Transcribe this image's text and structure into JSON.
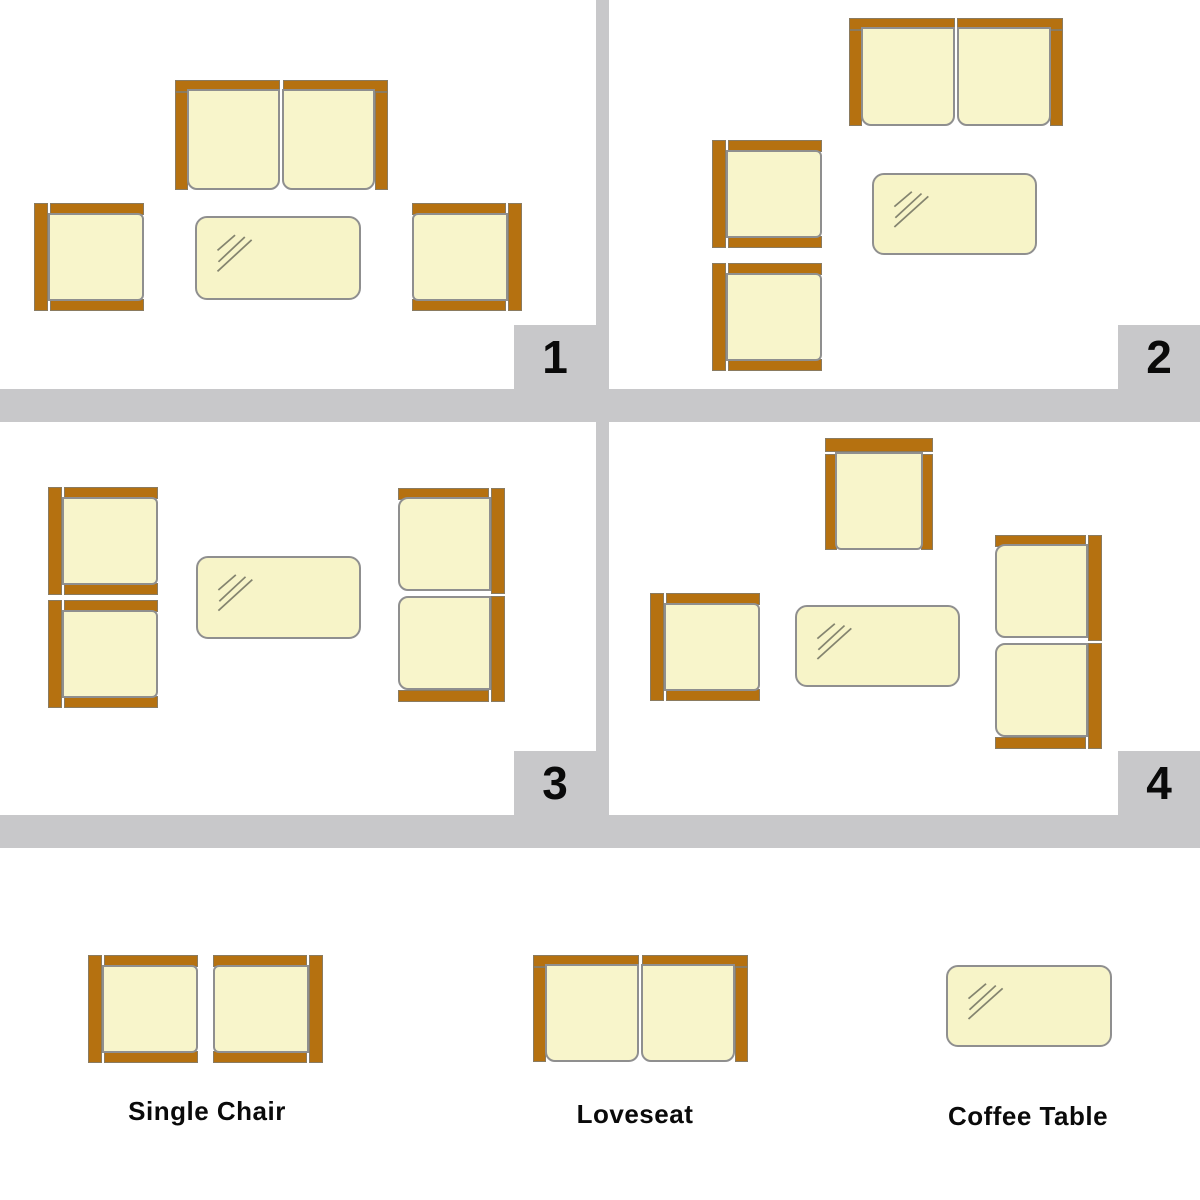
{
  "colors": {
    "frame_brown": "#b57110",
    "cushion_cream": "#f8f5cb",
    "table_cream": "#f7f4c8",
    "outline_gray": "#8f8f8f",
    "divider_gray": "#c8c8ca",
    "text_black": "#0a0a0a"
  },
  "quadrants": [
    {
      "label": "1"
    },
    {
      "label": "2"
    },
    {
      "label": "3"
    },
    {
      "label": "4"
    }
  ],
  "legend": {
    "entries": [
      {
        "label": "Single Chair"
      },
      {
        "label": "Loveseat"
      },
      {
        "label": "Coffee Table"
      }
    ]
  },
  "furniture": [
    {
      "name": "loveseat",
      "scene": "quadrant-1",
      "back": "top",
      "x": 175,
      "y": 80,
      "w": 213,
      "h": 110
    },
    {
      "name": "single-chair",
      "scene": "quadrant-1",
      "back": "left",
      "x": 34,
      "y": 203,
      "w": 110,
      "h": 108
    },
    {
      "name": "single-chair",
      "scene": "quadrant-1",
      "back": "right",
      "x": 412,
      "y": 203,
      "w": 110,
      "h": 108
    },
    {
      "name": "coffee-table",
      "scene": "quadrant-1",
      "x": 195,
      "y": 216,
      "w": 166,
      "h": 84
    },
    {
      "name": "loveseat",
      "scene": "quadrant-2",
      "back": "top",
      "x": 849,
      "y": 18,
      "w": 214,
      "h": 108
    },
    {
      "name": "single-chair",
      "scene": "quadrant-2",
      "back": "left",
      "x": 712,
      "y": 140,
      "w": 110,
      "h": 108
    },
    {
      "name": "single-chair",
      "scene": "quadrant-2",
      "back": "left",
      "x": 712,
      "y": 263,
      "w": 110,
      "h": 108
    },
    {
      "name": "coffee-table",
      "scene": "quadrant-2",
      "x": 872,
      "y": 173,
      "w": 165,
      "h": 82
    },
    {
      "name": "single-chair",
      "scene": "quadrant-3",
      "back": "left",
      "x": 48,
      "y": 487,
      "w": 110,
      "h": 108
    },
    {
      "name": "single-chair",
      "scene": "quadrant-3",
      "back": "left",
      "x": 48,
      "y": 600,
      "w": 110,
      "h": 108
    },
    {
      "name": "coffee-table",
      "scene": "quadrant-3",
      "x": 196,
      "y": 556,
      "w": 165,
      "h": 83
    },
    {
      "name": "loveseat",
      "scene": "quadrant-3",
      "back": "right",
      "x": 398,
      "y": 488,
      "w": 107,
      "h": 214
    },
    {
      "name": "single-chair",
      "scene": "quadrant-4",
      "back": "top",
      "x": 825,
      "y": 438,
      "w": 108,
      "h": 112
    },
    {
      "name": "single-chair",
      "scene": "quadrant-4",
      "back": "left",
      "x": 650,
      "y": 593,
      "w": 110,
      "h": 108
    },
    {
      "name": "coffee-table",
      "scene": "quadrant-4",
      "x": 795,
      "y": 605,
      "w": 165,
      "h": 82
    },
    {
      "name": "loveseat",
      "scene": "quadrant-4",
      "back": "right",
      "x": 995,
      "y": 535,
      "w": 107,
      "h": 214
    },
    {
      "name": "single-chair",
      "scene": "legend",
      "back": "left",
      "x": 88,
      "y": 955,
      "w": 110,
      "h": 108
    },
    {
      "name": "single-chair",
      "scene": "legend",
      "back": "right",
      "x": 213,
      "y": 955,
      "w": 110,
      "h": 108
    },
    {
      "name": "loveseat",
      "scene": "legend",
      "back": "top",
      "x": 533,
      "y": 955,
      "w": 215,
      "h": 107
    },
    {
      "name": "coffee-table",
      "scene": "legend",
      "x": 946,
      "y": 965,
      "w": 166,
      "h": 82
    }
  ]
}
